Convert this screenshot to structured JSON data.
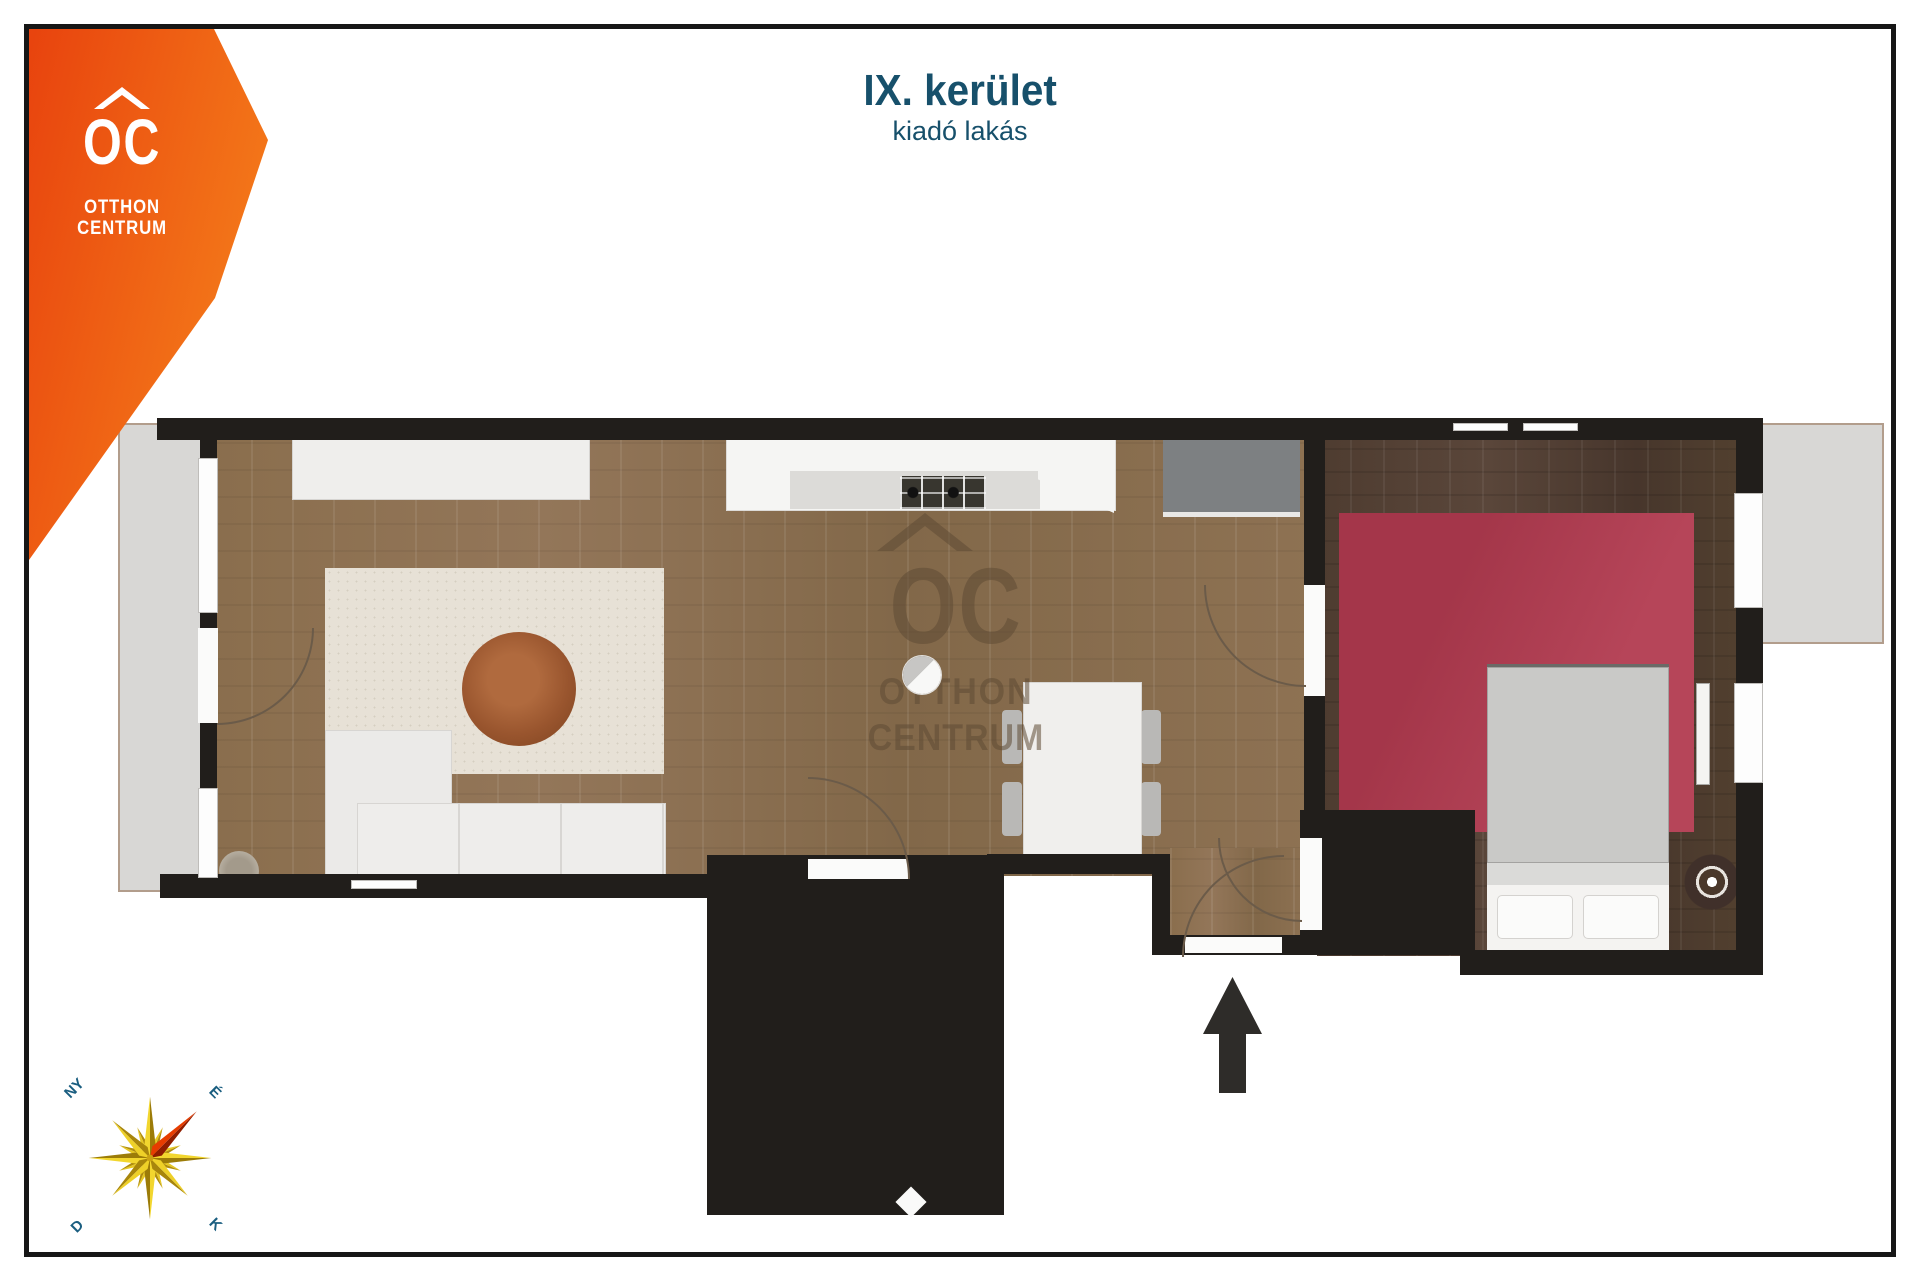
{
  "header": {
    "title": "IX. kerület",
    "subtitle": "kiadó lakás"
  },
  "logo": {
    "abbr": "OC",
    "line1": "OTTHON",
    "line2": "CENTRUM"
  },
  "watermark": {
    "abbr": "OC",
    "line1": "OTTHON",
    "line2": "CENTRUM"
  },
  "compass": {
    "west": "NY",
    "north": "É",
    "south": "D",
    "east": "K"
  },
  "colors": {
    "brand_orange_start": "#e8430e",
    "brand_orange_end": "#f57d1a",
    "title_teal": "#17506b",
    "wall_black": "#211e1b",
    "wood_light": "#8a6e4d",
    "wood_dark": "#4e3c30",
    "bedroom_rug_red": "#b23b50",
    "living_rug": "#e7e1d6",
    "marble": "#f1f0ee",
    "balcony_gray": "#d8d7d5",
    "compass_gold": "#e3c01c",
    "compass_red": "#e63c00"
  }
}
